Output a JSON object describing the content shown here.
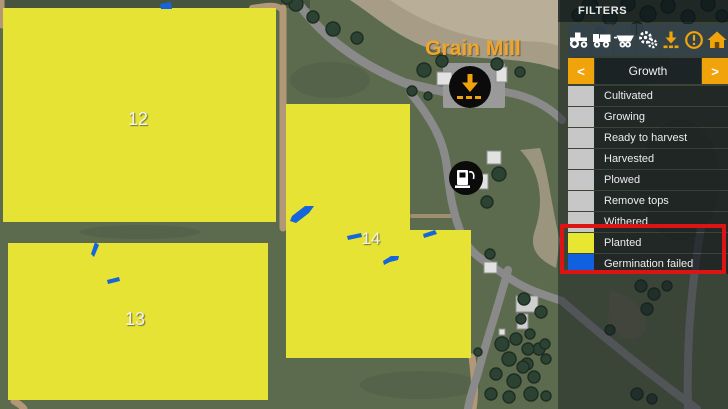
{
  "map": {
    "poi": {
      "grain_mill": "Grain Mill"
    },
    "fields": [
      {
        "number": "12"
      },
      {
        "number": "13"
      },
      {
        "number": "14"
      }
    ],
    "colors": {
      "planted": "#E6E335",
      "germination_failed": "#1565DB",
      "terrain": "#5C6B4E"
    }
  },
  "panel": {
    "title": "FILTERS",
    "accent": "#F0A30A",
    "toolbar": {
      "icons": [
        {
          "name": "tractor-icon",
          "color": "#FFFFFF"
        },
        {
          "name": "truck-icon",
          "color": "#FFFFFF"
        },
        {
          "name": "trailer-icon",
          "color": "#FFFFFF"
        },
        {
          "name": "gears-icon",
          "color": "#FFFFFF"
        },
        {
          "name": "unload-arrow-icon",
          "color": "#F0A30A"
        },
        {
          "name": "warning-icon",
          "color": "#F0A30A"
        },
        {
          "name": "home-icon",
          "color": "#F0A30A"
        }
      ]
    },
    "selector": {
      "label": "Growth",
      "prev": "<",
      "next": ">"
    },
    "filters": [
      {
        "label": "Cultivated",
        "swatch": "#C7C7C7"
      },
      {
        "label": "Growing",
        "swatch": "#C7C7C7"
      },
      {
        "label": "Ready to harvest",
        "swatch": "#C7C7C7"
      },
      {
        "label": "Harvested",
        "swatch": "#C7C7C7"
      },
      {
        "label": "Plowed",
        "swatch": "#C7C7C7"
      },
      {
        "label": "Remove tops",
        "swatch": "#C7C7C7"
      },
      {
        "label": "Withered",
        "swatch": "#C7C7C7"
      },
      {
        "label": "Planted",
        "swatch": "#E8E630"
      },
      {
        "label": "Germination failed",
        "swatch": "#1060DF"
      }
    ],
    "highlight": {
      "color": "#DD1414"
    }
  }
}
